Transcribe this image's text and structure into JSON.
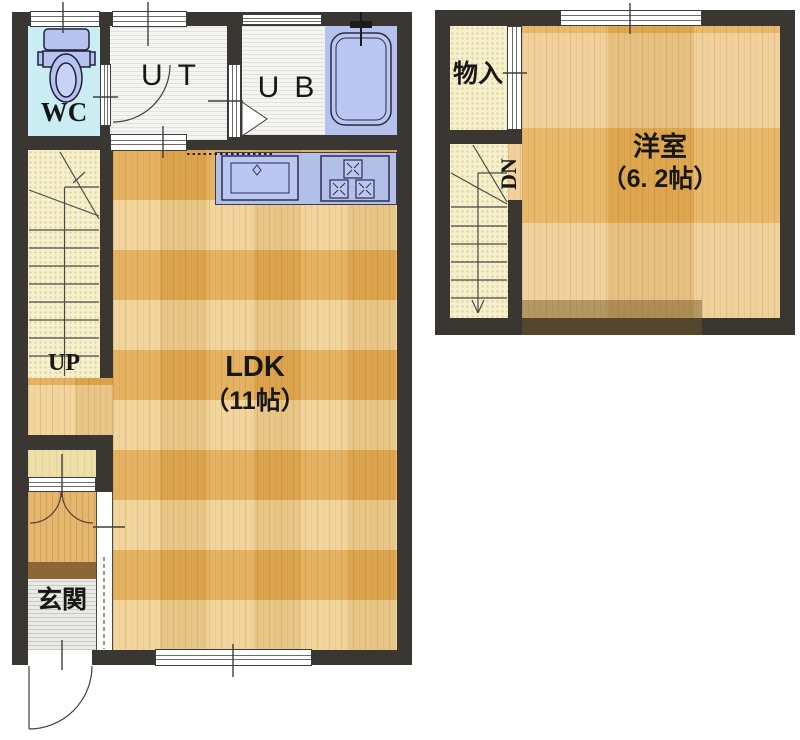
{
  "document": {
    "type": "floor-plan",
    "floors": 2
  },
  "floor1": {
    "labels": {
      "wc": "WC",
      "ut": "UT",
      "ub": "UB",
      "ldk": "LDK",
      "ldk_size": "（11帖）",
      "up": "UP",
      "genkan": "玄関"
    }
  },
  "floor2": {
    "labels": {
      "storage": "物入",
      "room": "洋室",
      "room_size": "（6. 2帖）",
      "dn": "DN"
    }
  },
  "colors": {
    "wall": "#3a3733",
    "wc_floor": "#c9edf3",
    "fixture_blue": "#b5c2ee",
    "counter_blue": "#b2bfe6",
    "wood_light": "#f0cf92",
    "wood_dark": "#e2a950",
    "stair_cream": "#f7f0cd",
    "entry_step_brown": "#8d6637"
  }
}
